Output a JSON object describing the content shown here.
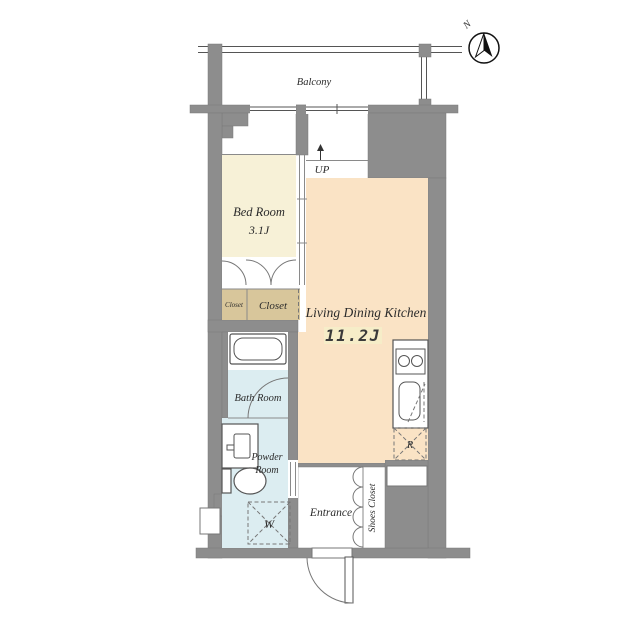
{
  "title": "Floor Plan",
  "compass": {
    "north_label": "N"
  },
  "rooms": {
    "balcony": {
      "label": "Balcony"
    },
    "bedroom": {
      "label": "Bed Room",
      "area": "3.1J"
    },
    "ldk": {
      "label": "Living Dining Kitchen",
      "area": "11.2J"
    },
    "bath": {
      "label": "Bath Room"
    },
    "powder": {
      "label_line1": "Powder",
      "label_line2": "Room"
    },
    "entrance": {
      "label": "Entrance"
    },
    "shoes_closet": {
      "label": "Shoes Closet"
    },
    "closet_small": {
      "label": "Closet"
    },
    "closet_large": {
      "label": "Closet"
    }
  },
  "markers": {
    "up": "UP",
    "washer": "W",
    "refrigerator": "R"
  },
  "colors": {
    "wall": "#8d8d8d",
    "bedroom_floor": "#f7f1d7",
    "ldk_floor": "#fae3c5",
    "closet_floor": "#d8c69b",
    "wet_floor": "#dcedf1",
    "area_highlight": "#f6edc8",
    "white": "#ffffff"
  }
}
